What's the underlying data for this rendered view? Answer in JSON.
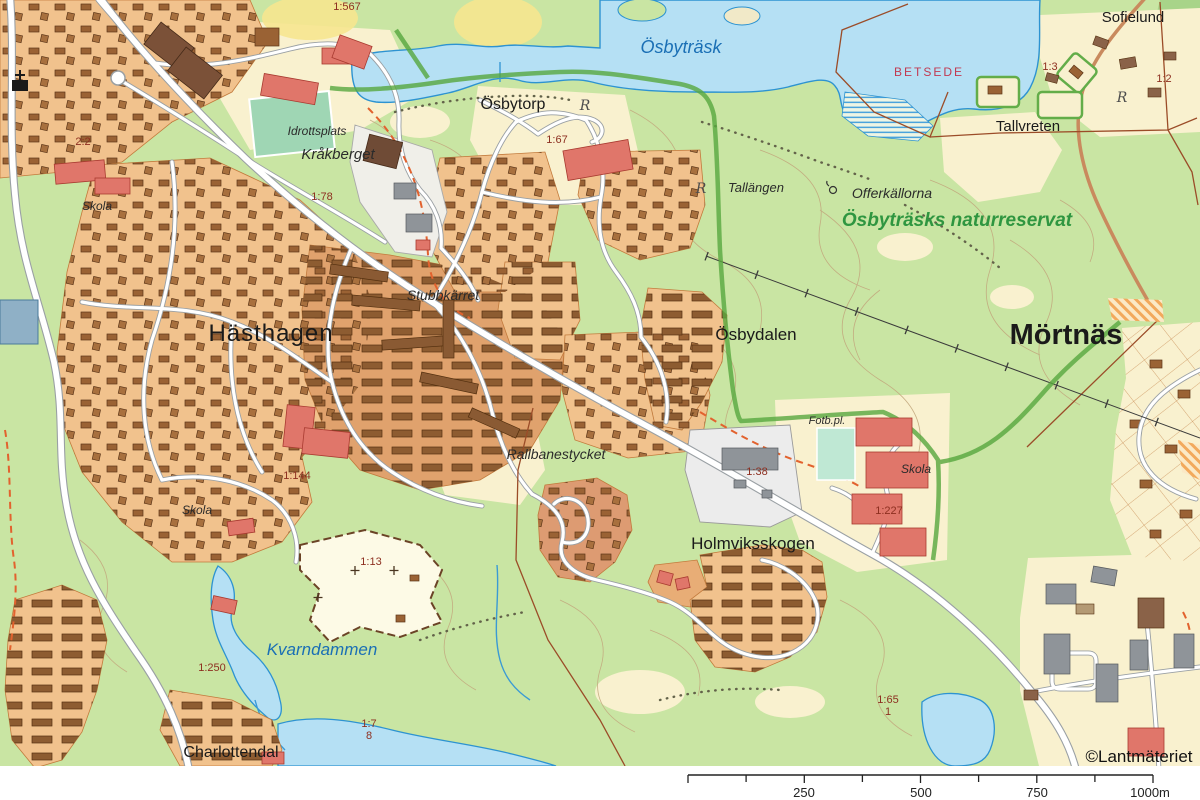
{
  "map": {
    "attribution": "©Lantmäteriet",
    "labels": {
      "parcel_1567": "1:567",
      "lake_osbytrask": "Ösbyträsk",
      "osbytorp": "Ösbytorp",
      "betsede": "BETSEDE",
      "sofielund": "Sofielund",
      "parcel_1_3": "1:3",
      "parcel_1_2": "1:2",
      "tallvreten": "Tallvreten",
      "tallangen": "Tallängen",
      "offerkallorna": "Offerkällorna",
      "naturreservat": "Ösbyträsks naturreservat",
      "idrottsplats": "Idrottsplats",
      "krakberget": "Kråkberget",
      "parcel_1_78": "1:78",
      "parcel_2_2": "2:2",
      "skola_west": "Skola",
      "parcel_1_67": "1:67",
      "hasthagen": "Hästhagen",
      "stubbkarret": "Stubbkärret",
      "osbydalen": "Ösbydalen",
      "mortnas": "Mörtnäs",
      "rallbanestycket": "Rallbanestycket",
      "fotbpl": "Fotb.pl.",
      "parcel_1_38": "1:38",
      "skola_east": "Skola",
      "parcel_1_227": "1:227",
      "holmviksskogen": "Holmviksskogen",
      "parcel_1_144": "1:144",
      "skola_southwest": "Skola",
      "parcel_1_13": "1:13",
      "kvarndammen": "Kvarndammen",
      "parcel_1_250": "1:250",
      "charlottendal": "Charlottendal",
      "parcel_1_7": "1:7",
      "parcel_1_7b": "8",
      "parcel_1_65": "1:65",
      "parcel_1_65b": "1",
      "rune_marker_1": "R",
      "rune_marker_2": "R",
      "rune_marker_3": "R"
    },
    "scale_bar": {
      "labels": [
        "250",
        "500",
        "750",
        "1000m"
      ]
    },
    "colors": {
      "forest_green": "#c9e5a3",
      "open_land_cream": "#f9f1cf",
      "water_fill": "#b5e0f4",
      "water_line": "#2d93d1",
      "residential_orange": "#f1c28d",
      "residential_dark": "#e0a26d",
      "building_brown": "#9a6234",
      "building_red": "#e0766a",
      "reserve_boundary_green": "#57a73e",
      "cadastral_red": "#8d2f20",
      "boundary_brown": "#9b4c28",
      "water_label_blue": "#1a6fb5",
      "reserve_label_green": "#2f9640",
      "betsede_red": "#c13a52"
    }
  }
}
